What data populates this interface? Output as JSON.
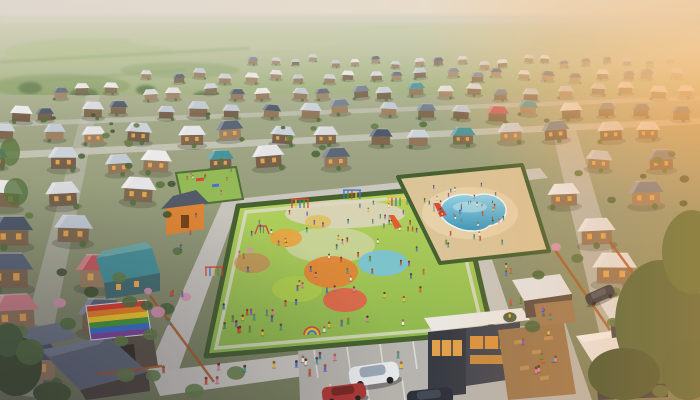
{
  "meta": {
    "title": "Aerial render of a suburban neighborhood at dusk with a central playground, splash pool, pride banner, cafe and parked cars"
  },
  "scene": {
    "description": "Photorealistic aerial view: grid of small single-storey houses with slate and pale roofs stretching to a hazy green plain; golden sunset glow from the right edge; central hedge-bordered playground crowded with children and colorful play circles; sandy splash-pool plaza with blue kidney-shaped pool; rainbow pride banner on a rooftop at lower left; modern cafe with glowing windows, timber deck and angle parking at bottom; large dark green trees in the foreground corners.",
    "palette": {
      "sun_glow": "#ffcf8a",
      "plain_far": "#c3cda6",
      "plain_near": "#86a164",
      "ground_far": "#a3ad8c",
      "ground_near": "#6f7a58",
      "road": "#c7c8c2",
      "parking": "#b3b4af",
      "stall_line": "#e9e9e4",
      "lawn": "#9cc455",
      "lawn_dark": "#7fae45",
      "hedge": "#3d5c2b",
      "path": "#e0dfd5",
      "sand": "#d9c498",
      "sand_light": "#e7d6ae",
      "pool_light": "#8fd4ea",
      "pool_deep": "#2f93bd",
      "window_glow": "#f2ae4d",
      "tree_dark": "#3a4f2c",
      "tree_mid": "#50703c",
      "blossom": "#d893b4",
      "fence_orange": "#a8551f",
      "cafe_wall": "#2e3440",
      "cafe_wall2": "#3a414e",
      "cafe_roof": "#e9e9e6",
      "deck": "#96744a"
    },
    "houses": {
      "rows": [
        {
          "y": 62,
          "s": 0.36,
          "x0": 252,
          "x1": 692,
          "step": 21
        },
        {
          "y": 77,
          "s": 0.46,
          "x0": 150,
          "x1": 692,
          "step": 25
        },
        {
          "y": 93,
          "s": 0.58,
          "x0": 56,
          "x1": 692,
          "step": 30
        },
        {
          "y": 112,
          "s": 0.72,
          "x0": 14,
          "x1": 694,
          "step": 37
        },
        {
          "y": 136,
          "s": 0.88,
          "x0": 6,
          "x1": 694,
          "step": 46
        },
        {
          "y": 163,
          "s": 1.05,
          "x0": 0,
          "x1": 696,
          "step": 55,
          "skip": [
            [
              388,
              552
            ]
          ]
        },
        {
          "y": 196,
          "s": 1.25,
          "x0": 0,
          "x1": 698,
          "step": 64,
          "skip": [
            [
              150,
              556
            ]
          ]
        },
        {
          "y": 233,
          "s": 1.45,
          "x0": 0,
          "x1": 698,
          "step": 76,
          "skip": [
            [
              152,
              562
            ]
          ]
        },
        {
          "y": 273,
          "s": 1.62,
          "x0": 0,
          "x1": 698,
          "step": 86,
          "skip": [
            [
              138,
              572
            ]
          ]
        },
        {
          "y": 318,
          "s": 1.85,
          "x0": 8,
          "x1": 698,
          "step": 98,
          "skip": [
            [
              118,
              700
            ]
          ]
        },
        {
          "y": 366,
          "s": 2.1,
          "x0": 20,
          "x1": 698,
          "step": 112,
          "skip": [
            [
              104,
              700
            ]
          ]
        }
      ],
      "roof_light": [
        "#c9d3dd",
        "#d8dde3",
        "#bfcbd7",
        "#e3e6ea"
      ],
      "roof_slate": [
        "#6b7c90",
        "#546476",
        "#465668"
      ],
      "roof_white": "#eaedef",
      "roof_accent": [
        "#bf6a6e",
        "#c4565e",
        "#cd8188"
      ],
      "roof_teal": "#3f929b",
      "walls": [
        "#8d7357",
        "#7a654c",
        "#997f60",
        "#6f5c49"
      ]
    },
    "playground": {
      "circles": [
        {
          "cx": 286,
          "cy": 238,
          "rx": 16,
          "ry": 9,
          "color": "#e6a23c"
        },
        {
          "cx": 318,
          "cy": 222,
          "rx": 13,
          "ry": 7,
          "color": "#e0b84a",
          "opacity": 0.7
        },
        {
          "cx": 297,
          "cy": 289,
          "rx": 25,
          "ry": 13,
          "color": "#a8cc49"
        },
        {
          "cx": 331,
          "cy": 272,
          "rx": 27,
          "ry": 16,
          "color": "#e08030"
        },
        {
          "cx": 345,
          "cy": 300,
          "rx": 22,
          "ry": 12,
          "color": "#dd5f45"
        },
        {
          "cx": 383,
          "cy": 263,
          "rx": 25,
          "ry": 13,
          "color": "#74c2da"
        },
        {
          "cx": 252,
          "cy": 263,
          "rx": 18,
          "ry": 10,
          "color": "#d86a55",
          "opacity": 0.5
        }
      ],
      "equipment": [
        {
          "type": "climber",
          "x": 300,
          "y": 208,
          "colors": [
            "#d8432f",
            "#f0c030",
            "#3a6fd8",
            "#3f9b35"
          ]
        },
        {
          "type": "climber",
          "x": 352,
          "y": 199,
          "colors": [
            "#3a6fd8",
            "#3f9b35",
            "#d8432f",
            "#f0c030"
          ]
        },
        {
          "type": "climber",
          "x": 396,
          "y": 206,
          "colors": [
            "#f0c030",
            "#d8432f",
            "#3a6fd8",
            "#3f9b35"
          ]
        },
        {
          "type": "climber",
          "x": 214,
          "y": 276,
          "colors": [
            "#d8432f",
            "#3a6fd8",
            "#f0c030",
            "#3f9b35"
          ]
        },
        {
          "type": "slide",
          "x": 434,
          "y": 212,
          "colors": [
            "#d8432f"
          ]
        },
        {
          "type": "slide",
          "x": 389,
          "y": 224,
          "colors": [
            "#e05a2a"
          ]
        },
        {
          "type": "swing",
          "x": 262,
          "y": 233,
          "colors": [
            "#c44c38"
          ]
        },
        {
          "type": "arch",
          "x": 312,
          "y": 334,
          "colors": [
            "#d8432f",
            "#f0c030",
            "#3a6fd8"
          ]
        }
      ]
    },
    "flag": {
      "quad": [
        [
          86,
          306
        ],
        [
          146,
          300
        ],
        [
          151,
          334
        ],
        [
          91,
          340
        ]
      ],
      "stripes": [
        "#d93a2b",
        "#f08020",
        "#f5d020",
        "#3f9b35",
        "#2f6fd0",
        "#7b3fa0"
      ]
    },
    "crowds": [
      {
        "name": "playground-crowd",
        "a": [
          245,
          214
        ],
        "b": [
          445,
          195
        ],
        "d": [
          214,
          344
        ],
        "count": 88
      },
      {
        "name": "pool-deck-crowd",
        "a": [
          406,
          184
        ],
        "b": [
          512,
          172
        ],
        "d": [
          438,
          252
        ],
        "count": 26
      },
      {
        "name": "pool-swimmers",
        "a": [
          446,
          202
        ],
        "b": [
          496,
          197
        ],
        "d": [
          452,
          226
        ],
        "count": 8,
        "water": true
      },
      {
        "name": "sidewalk-left",
        "a": [
          186,
          214
        ],
        "b": [
          200,
          212
        ],
        "d": [
          156,
          362
        ],
        "count": 7
      },
      {
        "name": "sidewalk-bottom",
        "a": [
          162,
          370
        ],
        "b": [
          335,
          348
        ],
        "d": [
          168,
          394
        ],
        "count": 11
      },
      {
        "name": "street-right",
        "a": [
          468,
          196
        ],
        "b": [
          486,
          194
        ],
        "d": [
          512,
          328
        ],
        "count": 9
      },
      {
        "name": "cafe-deck-crowd",
        "a": [
          504,
          336
        ],
        "b": [
          556,
          330
        ],
        "d": [
          514,
          392
        ],
        "count": 8
      },
      {
        "name": "mini-park-crowd",
        "a": [
          180,
          176
        ],
        "b": [
          232,
          170
        ],
        "d": [
          186,
          200
        ],
        "count": 9
      },
      {
        "name": "patio-crowd",
        "a": [
          540,
          307
        ],
        "b": [
          566,
          303
        ],
        "d": [
          545,
          322
        ],
        "count": 4
      },
      {
        "name": "parking-pedestrians",
        "a": [
          300,
          350
        ],
        "b": [
          420,
          338
        ],
        "d": [
          305,
          378
        ],
        "count": 5
      }
    ],
    "people": {
      "shirts": [
        "#d8432f",
        "#3a6fd8",
        "#f0c030",
        "#3f9b35",
        "#e87ab0",
        "#8a4ad8",
        "#f0f0ea",
        "#e05a2a",
        "#2aa0a0"
      ],
      "skins": [
        "#8a5a3a",
        "#6b4226",
        "#a06b44",
        "#59371f"
      ]
    },
    "vegetation": {
      "bush_count": 62,
      "greens": [
        "#3a4f2c",
        "#50703c",
        "#5d7c46",
        "#446238"
      ],
      "exclude": [
        [
          200,
          180,
          300,
          185
        ],
        [
          390,
          155,
          165,
          110
        ],
        [
          290,
          330,
          310,
          70
        ]
      ],
      "blossoms": [
        {
          "x": 158,
          "y": 312,
          "r": 7
        },
        {
          "x": 186,
          "y": 297,
          "r": 5
        },
        {
          "x": 60,
          "y": 303,
          "r": 6
        },
        {
          "x": 148,
          "y": 291,
          "r": 4
        },
        {
          "x": 556,
          "y": 247,
          "r": 5
        },
        {
          "x": 640,
          "y": 306,
          "r": 8
        },
        {
          "x": 250,
          "y": 250,
          "r": 3
        }
      ]
    },
    "cars": [
      {
        "name": "white-minivan",
        "x": 374,
        "y": 374,
        "w": 50,
        "h": 20,
        "rot": -8,
        "body": "#e8ecef",
        "top": "#8fa2b4"
      },
      {
        "name": "red-car",
        "x": 344,
        "y": 393,
        "w": 44,
        "h": 16,
        "rot": -7,
        "body": "#a83230",
        "top": "#6e1f1d"
      },
      {
        "name": "dark-car",
        "x": 430,
        "y": 397,
        "w": 46,
        "h": 16,
        "rot": -6,
        "body": "#232a36",
        "top": "#3c4654"
      },
      {
        "name": "parked-suv",
        "x": 600,
        "y": 295,
        "w": 30,
        "h": 12,
        "rot": -24,
        "body": "#2c3542",
        "top": "#47525f"
      }
    ]
  }
}
